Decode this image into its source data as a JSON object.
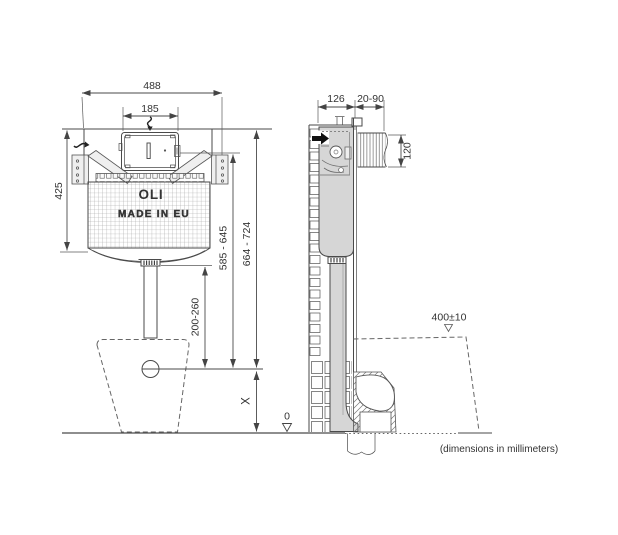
{
  "footer": {
    "note": "(dimensions in millimeters)"
  },
  "branding": {
    "logo": "OLI",
    "origin": "MADE IN EU"
  },
  "front": {
    "overall_width": "488",
    "panel_width": "185",
    "frame_height": "425",
    "panel_center_height": "585 - 645",
    "top_height": "664 - 724",
    "outlet_range": "200-260",
    "outlet_axis": "X",
    "floor_datum": "0"
  },
  "side": {
    "depth": "126",
    "wall_thickness": "20-90",
    "opening_height": "120",
    "bowl_rim_height": "400±10"
  }
}
